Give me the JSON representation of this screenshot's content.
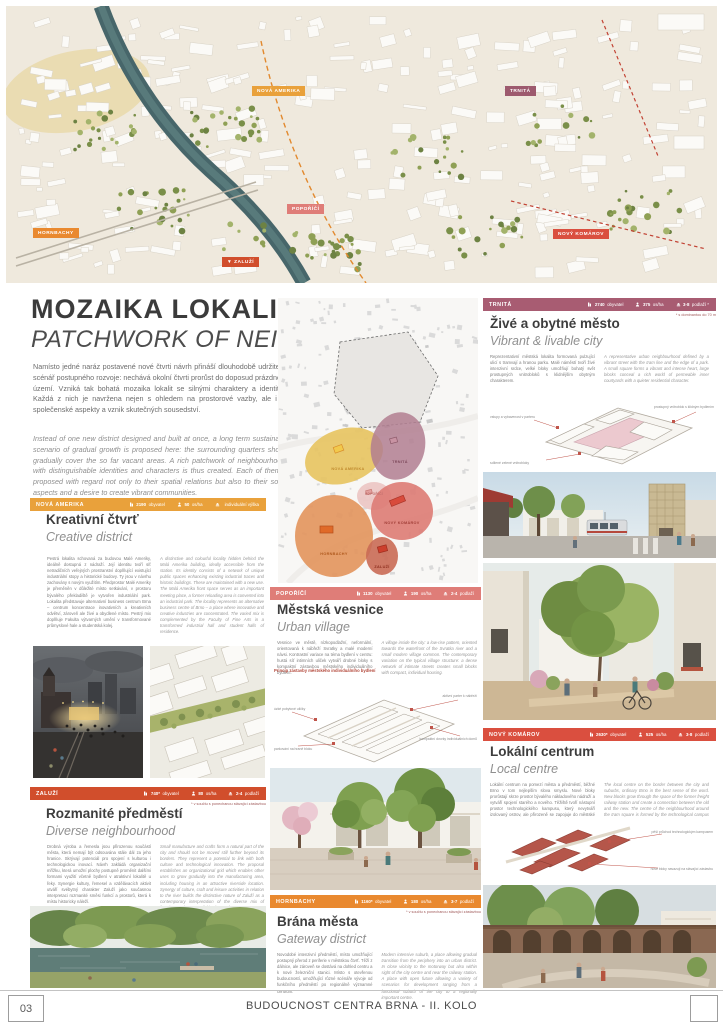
{
  "poster": {
    "title_cs": "MOZAIKA LOKALIT",
    "title_en": "PATCHWORK OF NEIGHBOURHOODS",
    "intro_cs": "Namísto jedné naráz postavené nové čtvrti návrh přináší dlouhodobě udržitelný scénář postupného rozvoje: nechává okolní čtvrti prorůst do doposud prázdného území. Vzniká tak bohatá mozaika lokalit se silnými charaktery a identitou. Každá z nich je navržena nejen s ohledem na prostorové vazby, ale i na společenské aspekty a vznik skutečných sousedství.",
    "intro_en": "Instead of one new district designed and built at once, a long term sustainable scenario of gradual growth is proposed here: the surrounding quarters should gradually cover the so far vacant areas. A rich patchwork of neighbourhoods with distinguishable identities and characters is thus created. Each of them is proposed with regard not only to their spatial relations but also to their social aspects and a desire to create vibrant communities."
  },
  "aerial": {
    "labels": [
      "NOVÁ AMERIKA",
      "TRNITÁ",
      "POPOŘÍČÍ",
      "HORNBACHY",
      "NOVÝ KOMÁROV",
      "▼ ZALUŽÍ"
    ]
  },
  "map": {
    "labels": [
      "NOVÁ AMERIKA",
      "TRNITÁ",
      "POPOŘÍČÍ",
      "NOVÝ KOMÁROV",
      "HORNBACHY",
      "ZALUŽÍ"
    ]
  },
  "neighbourhoods": [
    {
      "name": "NOVÁ AMERIKA",
      "color": "#E9A13B",
      "population": {
        "value": "2190",
        "unit": "obyvatel"
      },
      "density": {
        "value": "50",
        "unit": "os/ha"
      },
      "floors": {
        "value": "",
        "unit": "individuální výška"
      },
      "footnote": "",
      "title_cs": "Kreativní čtvrť",
      "title_en": "Creative district",
      "text_cs": "Pestrá lokalita schovaná za budovou Malé Ameriky, ideálně dostupná z nádraží. Její identitu tvoří síť netradičních veřejných prostranství doplňující existující industriální stopy a historické budovy. Ty jsou v návrhu zachovány s novým využitím. Předprostor Malé Ameriky je přeměněn v důležité místo setkávání, v prostoru bývalého překladiště je vytvořen industriální park. Lokalita představuje alternativní business centrum Brna – centrum koncentrace inovativních a kreativních odvětví, zároveň ale živé a obydlené místo. Pestrý mix doplňuje Fakulta výtvarných umění v transformované průmyslové hale a studentská kolej.",
      "text_en": "A distinctive and colourful locality hidden behind the Malá Amerika building, ideally accessible from the station. Its identity consists of a network of unique public spaces enhancing existing industrial traces and historic buildings. These are maintained with a new use. The Malá Amerika front space serves as an important meeting place, a former reloading area is converted into an industrial park. The locality represents an alternative business centre of Brno – a place where innovative and creative industries are concentrated. The varied mix is complemented by the Faculty of Fine Arts in a transformed industrial hall and student halls of residence."
    },
    {
      "name": "TRNITÁ",
      "color": "#A85C72",
      "population": {
        "value": "2740",
        "unit": "obyvatel"
      },
      "density": {
        "value": "375",
        "unit": "os/ha"
      },
      "floors": {
        "value": "3-8",
        "unit": "podlaží *"
      },
      "footnote": "* s dominantou do 70 m",
      "title_cs": "Živé a obytné město",
      "title_en": "Vibrant & livable city",
      "text_cs": "Reprezentativní městská lokalita formovaná pulzující ulicí s tramvají a hranou parku. Malé náměstí tvoří živé intenzivní srdce, velké bloky umožňují bohatý svět prostupných vnitrobloků s klidnějším obytným charakterem.",
      "text_en": "A representative urban neighbourhood defined by a vibrant street with the tram line and the edge of a park. A small square forms a vibrant and intense heart, large blocks conceal a rich world of permeable inner courtyards with a quieter residential character.",
      "diagram_label_cs": "Prostupný superblok",
      "diagram_label_en": "Permeable superblock",
      "annotations": [
        "vstupy a vybavenost v parteru",
        "sdílené zelené vnitrobloky",
        "prostupný vnitroblok s klidným bydlením"
      ]
    },
    {
      "name": "POPOŘÍČÍ",
      "color": "#DF7D78",
      "population": {
        "value": "1130",
        "unit": "obyvatel"
      },
      "density": {
        "value": "190",
        "unit": "os/ha"
      },
      "floors": {
        "value": "2-4",
        "unit": "podlaží"
      },
      "footnote": "",
      "title_cs": "Městská vesnice",
      "title_en": "Urban village",
      "text_cs": "Vesnice ve městě, nízkopodlažní, neformální, orientovaná k nábřeží Svratky a malé moderní návsi. Kontrastní variace na téma bydlení v centru: hustá síť intimních uliček vytváří drobné bloky s kompaktní zástavbou městského individuálního bydlení.",
      "text_en": "A village inside the city: a low-rise pattern, oriented towards the waterfront of the Svratka river and a small modern village common. The contemporary variation on the typical village structure: a dense network of intimate streets creates small blocks with compact, individual housing.",
      "diagram_title": "Princip zástavby městského individuálního bydlení",
      "annotations": [
        "úzké pobytové uličky",
        "aktivní parter k nábřeží",
        "kompaktní dvorky individuálních domů",
        "parkování na hraně bloku"
      ]
    },
    {
      "name": "ZALUŽÍ",
      "color": "#D14E2C",
      "population": {
        "value": "740*",
        "unit": "obyvatel"
      },
      "density": {
        "value": "80",
        "unit": "os/ha"
      },
      "floors": {
        "value": "2-4",
        "unit": "podlaží"
      },
      "footnote": "* v součtu s ponechanou stávající zástavbou",
      "title_cs": "Rozmanité předměstí",
      "title_en": "Diverse neighbourhood",
      "text_cs": "Drobná výroba a řemesla jsou přirozenou součástí města, která nemají být odsouvána stále dál za jeho hranice. Skrývají potenciál pro spojení s kulturou i technologickou inovací. Návrh zakládá organizační mřížku, která umožní plochy postupně proměnit dalšími formami využití včetně bydlení v atraktivní lokalitě u řeky. Synergie kultury, řemesel a vzdělávacích aktivit utváří svébytný charakter Zaluží jako současnou interpretaci rozmanité směsi funkcí a prostorů, která k místu historicky náleží.",
      "text_en": "Small manufacture and crafts form a natural part of the city and should not be moved still further beyond its borders. They represent a potential to link with both culture and technological innovation. The proposal establishes an organizational grid which enables other uses to grow gradually into the manufacturing area, including housing in an attractive riverside location. Synergy of culture, craft and leisure activities in relation to the river builds the distinctive nature of Zaluží as a contemporary interpretation of the diverse mix of functions and spaces of this place today."
    },
    {
      "name": "HORNBACHY",
      "color": "#E9892F",
      "population": {
        "value": "1160*",
        "unit": "obyvatel"
      },
      "density": {
        "value": "180",
        "unit": "os/ha"
      },
      "floors": {
        "value": "3-7",
        "unit": "podlaží"
      },
      "footnote": "* v součtu s ponechanou stávající zástavbou",
      "title_cs": "Brána města",
      "title_en": "Gateway district",
      "text_cs": "Novodobé intenzivní předměstí, místo umožňující postupný přerod z periferie v městskou čtvrť. Těží z dálnice, ale zároveň se dostává na dohled centru a k nové železniční stanici. Místo s otevřenou budoucností, umožňující různé scénáře vývoje od funkčního předměstí po regionálně významné centrum.",
      "text_en": "Modern intensive suburb, a place allowing gradual transition from the periphery into an urban district. In close vicinity to the motorway but also within sight of the city centre and near the railway station. A place with open future allowing a variety of scenarios for development ranging from a functional suburb of the city to a regionally important centre."
    },
    {
      "name": "NOVÝ KOMÁROV",
      "color": "#DA4F3F",
      "population": {
        "value": "2630*",
        "unit": "obyvatel"
      },
      "density": {
        "value": "525",
        "unit": "os/ha"
      },
      "floors": {
        "value": "3-8",
        "unit": "podlaží"
      },
      "footnote": "",
      "title_cs": "Lokální centrum",
      "title_en": "Local centre",
      "text_cs": "Lokální centrum na pomezí města a předměstí, běžné Brno v tom nejlepším slova smyslu. Nové bloky prorůstají skrze prostor bývalého nákladového nádraží a vytváří spojení starého a nového. Těžiště tvoří nástupní prostor technologického kampusu, který nevytváří izolovaný ostrov, ale přirozeně se zapojuje do městské struktury.",
      "text_en": "The local centre on the border between the city and suburbs, ordinary Brno in the best sense of the word. New blocks grow through the space of the former freight railway station and create a connection between the old and the new. The centre of the neighbourhood around the tram square is formed by the technological campus that does not create an isolated island but is naturally integrated in the urban fabric.",
      "annotations": [
        "pěší průchod technologickým kampusem",
        "nové bloky navazují na stávající zástavbu"
      ]
    }
  ],
  "footer": {
    "page_number": "03",
    "title": "BUDOUCNOST CENTRA BRNA - II. KOLO"
  }
}
